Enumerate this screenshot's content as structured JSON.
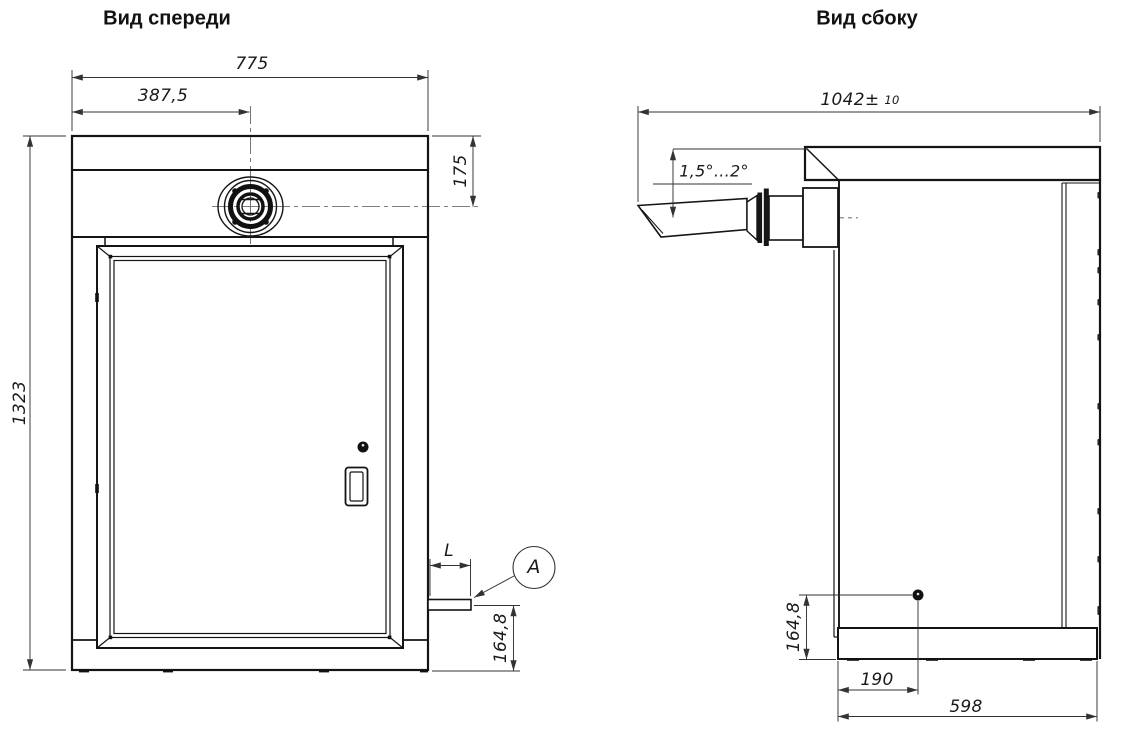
{
  "drawing": {
    "background": "#ffffff",
    "line_color": "#1a1a1a",
    "dim_color": "#333333",
    "front_view": {
      "title": "Вид спереди",
      "dims": {
        "overall_width": "775",
        "inlet_center_offset": "387,5",
        "overall_height": "1323",
        "inlet_top_offset": "175",
        "drain_stub_length": "L",
        "drain_height": "164,8",
        "detail_callout": "A"
      }
    },
    "side_view": {
      "title": "Вид сбоку",
      "dims": {
        "overall_depth": "1042±",
        "depth_tolerance": "10",
        "chute_angle": "1,5°...2°",
        "bolt_height": "164,8",
        "bolt_offset": "190",
        "base_depth": "598"
      }
    }
  }
}
